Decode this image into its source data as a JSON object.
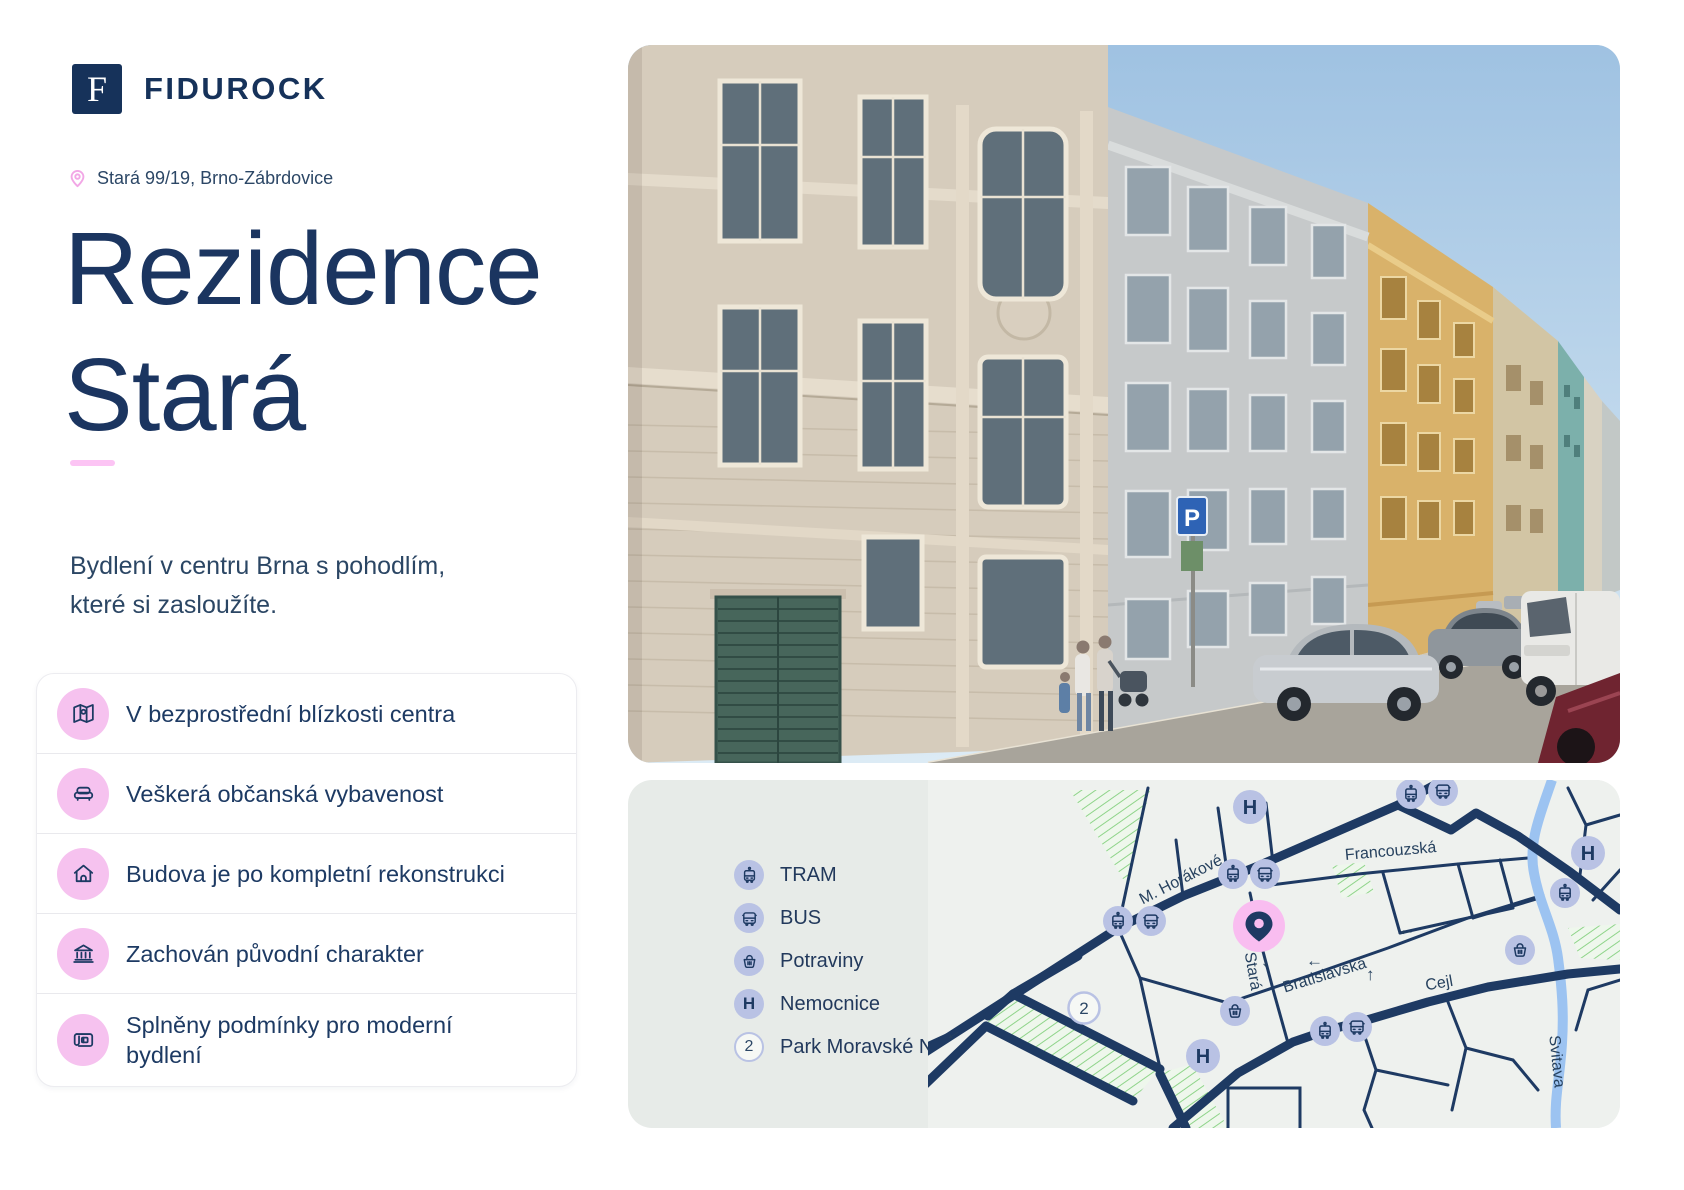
{
  "brand": {
    "logo_letter": "F",
    "name": "FIDUROCK"
  },
  "hero": {
    "location": "Stará 99/19, Brno-Zábrdovice",
    "title_line1": "Rezidence",
    "title_line2": "Stará",
    "subtitle_line1": "Bydlení v centru Brna s pohodlím,",
    "subtitle_line2": "které si zasloužíte."
  },
  "features": [
    {
      "icon": "map-location-icon",
      "label": "V bezprostřední blízkosti centra"
    },
    {
      "icon": "sofa-icon",
      "label": "Veškerá občanská vybavenost"
    },
    {
      "icon": "house-icon",
      "label": "Budova je po kompletní rekonstrukci"
    },
    {
      "icon": "bank-icon",
      "label": "Zachován původní charakter"
    },
    {
      "icon": "blueprint-icon",
      "label": "Splněny podmínky pro moderní",
      "label_line2": "bydlení"
    }
  ],
  "map": {
    "legend": [
      {
        "icon": "tram-icon",
        "label": "TRAM"
      },
      {
        "icon": "bus-icon",
        "label": "BUS"
      },
      {
        "icon": "grocery-basket-icon",
        "label": "Potraviny"
      },
      {
        "icon": "hospital-icon",
        "label": "Nemocnice"
      },
      {
        "icon": "park-number-marker",
        "label": "Park Moravské Náměstí"
      }
    ],
    "hospital_letter": "H",
    "park_number": "2",
    "streets": {
      "horakove": "M. Horákové",
      "francouzska": "Francouzská",
      "stara": "Stará",
      "bratislavska": "Bratislavská",
      "cejl": "Cejl"
    },
    "river": "Svitava",
    "arrows": {
      "left": "←",
      "up": "↑",
      "down": "↓"
    }
  },
  "photo": {
    "parking_sign_letter": "P"
  },
  "colors": {
    "navy": "#1c3a63",
    "title_navy": "#1b3560",
    "pink_accent": "#fcc4f4",
    "pink_icon_bg": "#f6c2ef",
    "pink_pin": "#f9bdf0",
    "lavender_icon_bg": "#b9c2e4",
    "map_card_bg": "#e7ebe8",
    "map_bg": "#eef1ee",
    "park_green": "#8fd48a",
    "river_blue": "#9cc3f1"
  }
}
